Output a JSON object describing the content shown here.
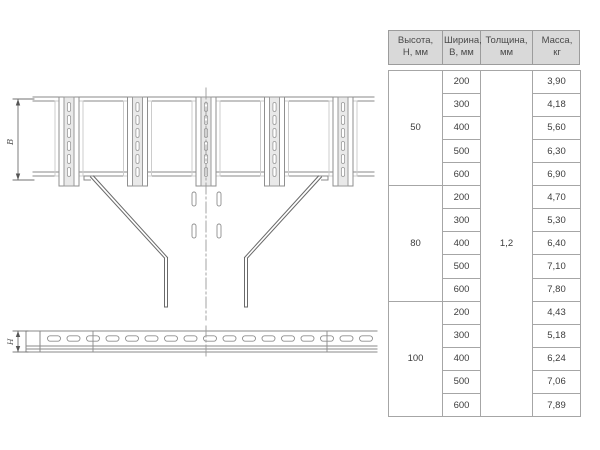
{
  "drawing": {
    "top_view": {
      "dimension_label": "В"
    },
    "bottom_view": {
      "dimension_label": "Н"
    }
  },
  "table": {
    "headers": [
      {
        "line1": "Высота,",
        "line2": "Н, мм"
      },
      {
        "line1": "Ширина,",
        "line2": "В, мм"
      },
      {
        "line1": "Толщина,",
        "line2": "мм"
      },
      {
        "line1": "Масса,",
        "line2": "кг"
      }
    ],
    "thickness": "1,2",
    "groups": [
      {
        "height": "50",
        "rows": [
          {
            "width": "200",
            "mass": "3,90"
          },
          {
            "width": "300",
            "mass": "4,18"
          },
          {
            "width": "400",
            "mass": "5,60"
          },
          {
            "width": "500",
            "mass": "6,30"
          },
          {
            "width": "600",
            "mass": "6,90"
          }
        ]
      },
      {
        "height": "80",
        "rows": [
          {
            "width": "200",
            "mass": "4,70"
          },
          {
            "width": "300",
            "mass": "5,30"
          },
          {
            "width": "400",
            "mass": "6,40"
          },
          {
            "width": "500",
            "mass": "7,10"
          },
          {
            "width": "600",
            "mass": "7,80"
          }
        ]
      },
      {
        "height": "100",
        "rows": [
          {
            "width": "200",
            "mass": "4,43"
          },
          {
            "width": "300",
            "mass": "5,18"
          },
          {
            "width": "400",
            "mass": "6,24"
          },
          {
            "width": "500",
            "mass": "7,06"
          },
          {
            "width": "600",
            "mass": "7,89"
          }
        ]
      }
    ]
  }
}
